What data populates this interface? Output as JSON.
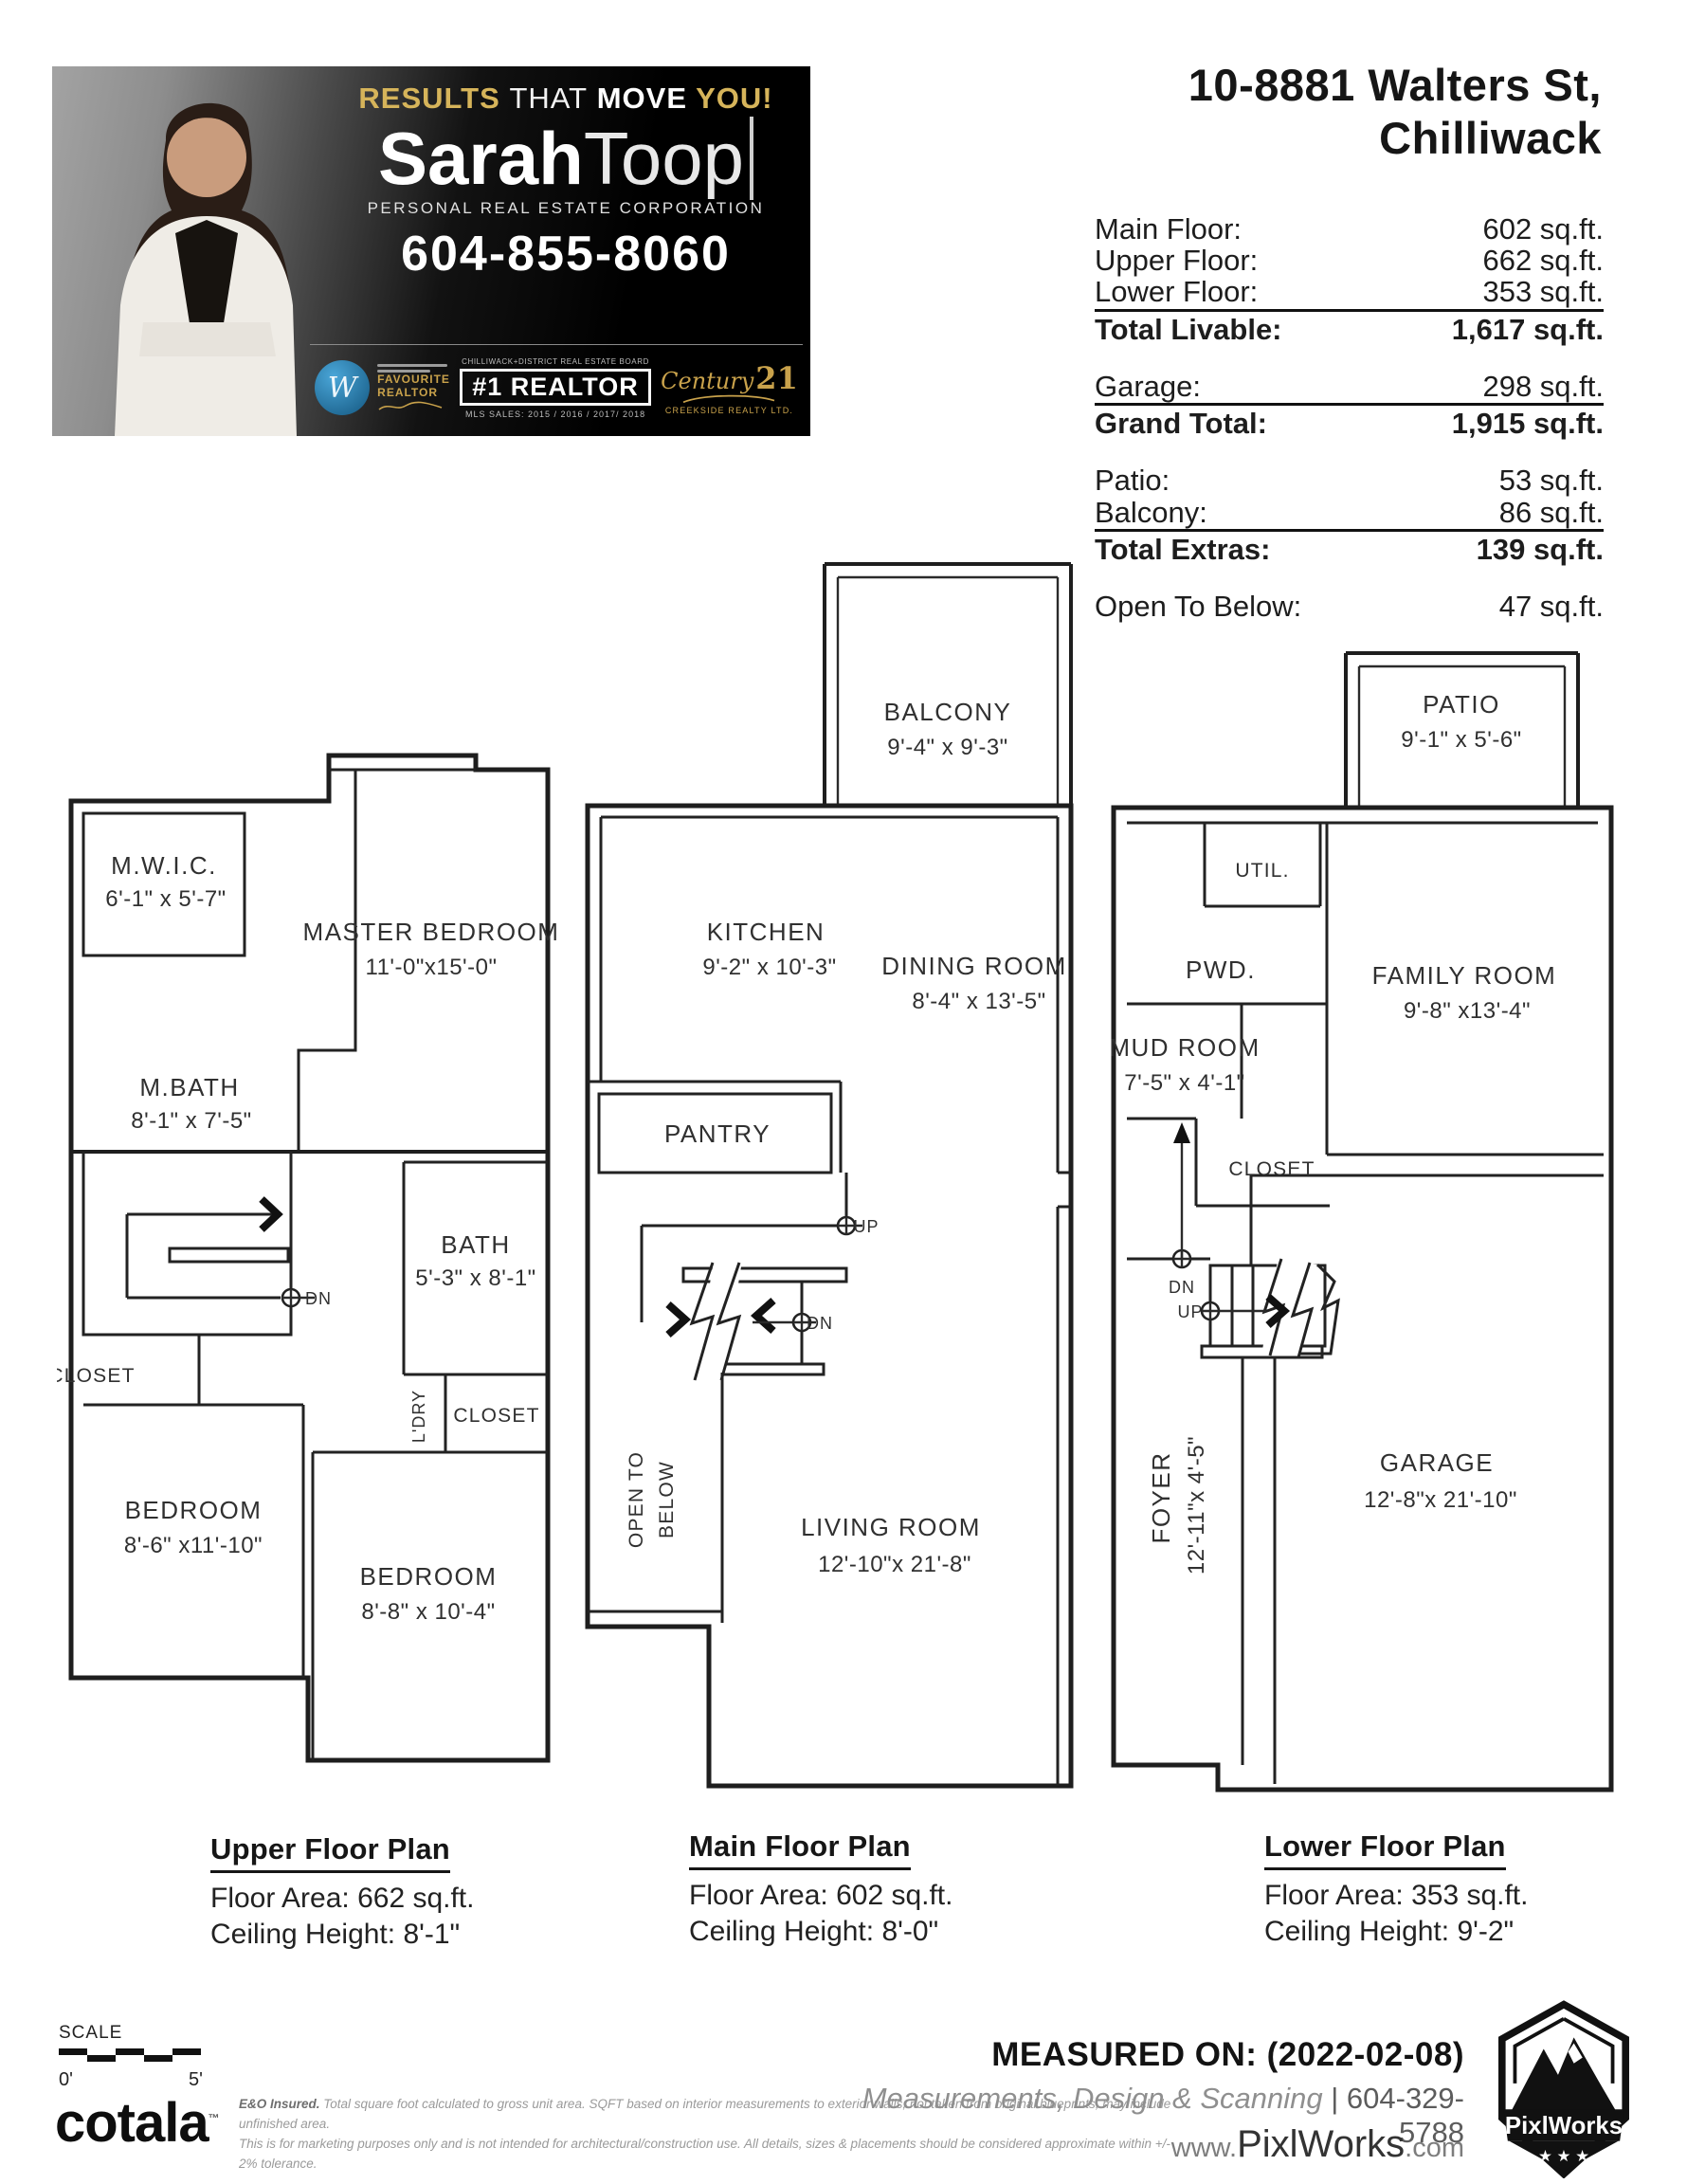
{
  "banner": {
    "tagline": {
      "results": "RESULTS",
      "that": "THAT",
      "move": "MOVE",
      "you": "YOU!"
    },
    "name_first": "Sarah",
    "name_last": "Toop",
    "subtitle": "PERSONAL REAL ESTATE CORPORATION",
    "phone": "604-855-8060",
    "badges": {
      "favourite_line1": "FAVOURITE",
      "favourite_line2": "REALTOR",
      "board": "CHILLIWACK+DISTRICT REAL ESTATE BOARD",
      "number_one": "#1 REALTOR",
      "mls": "MLS SALES: 2015 / 2016 / 2017/ 2018",
      "century_name": "Century",
      "century_num": "21",
      "century_sub": "CREEKSIDE REALTY LTD."
    },
    "colors": {
      "gold": "#c9a24b",
      "dark": "#000000",
      "badge_blue": "#2a8fc7"
    }
  },
  "header": {
    "address_line1": "10-8881 Walters St,",
    "address_line2": "Chilliwack"
  },
  "areas": {
    "g1": {
      "r1": {
        "label": "Main Floor:",
        "value": "602 sq.ft."
      },
      "r2": {
        "label": "Upper Floor:",
        "value": "662 sq.ft."
      },
      "r3": {
        "label": "Lower Floor:",
        "value": "353 sq.ft."
      },
      "total": {
        "label": "Total Livable:",
        "value": "1,617 sq.ft."
      }
    },
    "g2": {
      "r1": {
        "label": "Garage:",
        "value": "298 sq.ft."
      },
      "total": {
        "label": "Grand Total:",
        "value": "1,915 sq.ft."
      }
    },
    "g3": {
      "r1": {
        "label": "Patio:",
        "value": "53 sq.ft."
      },
      "r2": {
        "label": "Balcony:",
        "value": "86 sq.ft."
      },
      "total": {
        "label": "Total Extras:",
        "value": "139 sq.ft."
      }
    },
    "g4": {
      "r1": {
        "label": "Open To Below:",
        "value": "47 sq.ft."
      }
    }
  },
  "plans": {
    "upper": {
      "title": "Upper Floor Plan",
      "area": "Floor Area: 662 sq.ft.",
      "ceiling": "Ceiling Height: 8'-1\"",
      "mwic": "M.W.I.C.",
      "mwic_dims": "6'-1\" x 5'-7\"",
      "master": "MASTER BEDROOM",
      "master_dims": "11'-0\"x15'-0\"",
      "mbath": "M.BATH",
      "mbath_dims": "8'-1\" x 7'-5\"",
      "bath": "BATH",
      "bath_dims": "5'-3\" x 8'-1\"",
      "closet_left": "CLOSET",
      "ldry": "L'DRY",
      "closet_right": "CLOSET",
      "bedroom1": "BEDROOM",
      "bedroom1_dims": "8'-6\" x11'-10\"",
      "bedroom2": "BEDROOM",
      "bedroom2_dims": "8'-8\" x 10'-4\"",
      "dn": "DN"
    },
    "main": {
      "title": "Main Floor Plan",
      "area": "Floor Area: 602 sq.ft.",
      "ceiling": "Ceiling Height: 8'-0\"",
      "balcony": "BALCONY",
      "balcony_dims": "9'-4\" x 9'-3\"",
      "kitchen": "KITCHEN",
      "kitchen_dims": "9'-2\" x 10'-3\"",
      "dining": "DINING ROOM",
      "dining_dims": "8'-4\" x 13'-5\"",
      "pantry": "PANTRY",
      "up": "UP",
      "dn": "DN",
      "open_1": "OPEN TO",
      "open_2": "BELOW",
      "living": "LIVING ROOM",
      "living_dims": "12'-10\"x  21'-8\""
    },
    "lower": {
      "title": "Lower Floor Plan",
      "area": "Floor Area: 353 sq.ft.",
      "ceiling": "Ceiling Height: 9'-2\"",
      "patio": "PATIO",
      "patio_dims": "9'-1\" x 5'-6\"",
      "util": "UTIL.",
      "pwd": "PWD.",
      "family": "FAMILY ROOM",
      "family_dims": "9'-8\" x13'-4\"",
      "mud": "MUD ROOM",
      "mud_dims": "7'-5\" x 4'-1\"",
      "closet": "CLOSET",
      "dn": "DN",
      "up": "UP",
      "foyer": "FOYER",
      "foyer_dims": "12'-11\"x 4'-5\"",
      "garage": "GARAGE",
      "garage_dims": "12'-8\"x 21'-10\""
    }
  },
  "footer": {
    "scale_label": "SCALE",
    "scale_zero": "0'",
    "scale_five": "5'",
    "cotala": "cotala",
    "cotala_tm": "™",
    "disclaimer_bold": "E&O Insured.",
    "disclaimer_line1": "Total square foot calculated to gross unit area. SQFT based on interior measurements to exterior walls, not taken from original blueprints, may include unfinished area.",
    "disclaimer_line2": "This is for marketing purposes only and is not intended for architectural/construction use.  All details, sizes & placements should be considered approximate within +/- 2%  tolerance.",
    "measured_on": "MEASURED ON: (2022-02-08)",
    "services": "Measurements, Design & Scanning",
    "services_phone": "| 604-329-5788",
    "web_www": "www.",
    "web_name": "PixlWorks",
    "web_com": ".com",
    "pixlworks": "PixlWorks"
  }
}
